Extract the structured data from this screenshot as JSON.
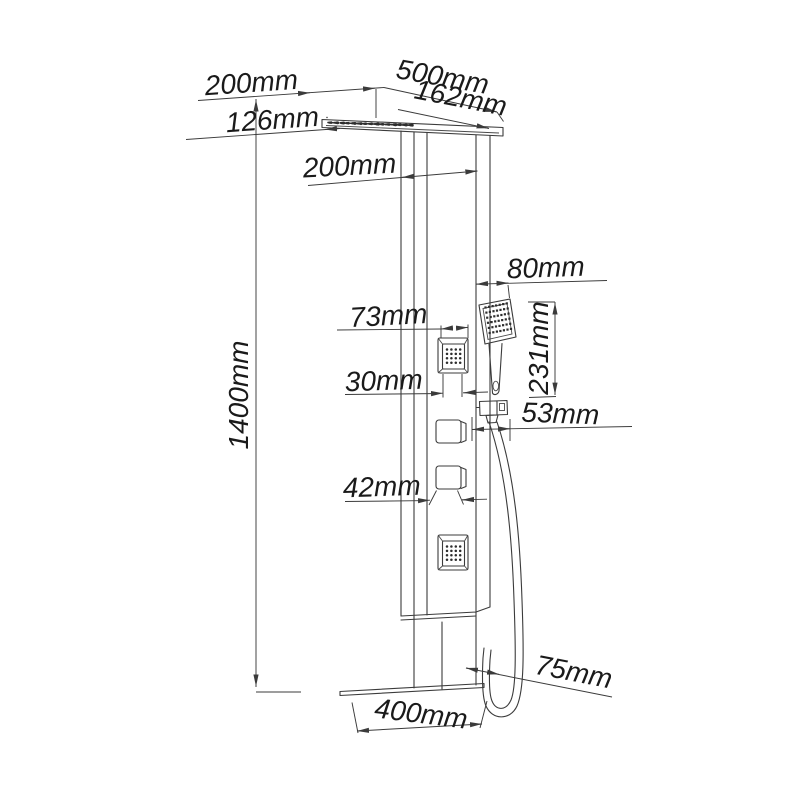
{
  "drawing": {
    "subject": "shower panel dimension drawing",
    "unit": "mm",
    "line_color": "#3b3b3b",
    "text_color": "#1a1a1a",
    "background_color": "#ffffff",
    "labels": {
      "top_offset": "200mm",
      "head_width": "500mm",
      "nozzle_offset": "126mm",
      "head_depth": "162mm",
      "column_width": "200mm",
      "total_height": "1400mm",
      "jet_width": "73mm",
      "handshower_width": "80mm",
      "jet_face_width": "30mm",
      "handshower_height": "231mm",
      "holder_width": "53mm",
      "knob_width": "42mm",
      "spout_depth": "75mm",
      "spout_length": "400mm"
    }
  }
}
